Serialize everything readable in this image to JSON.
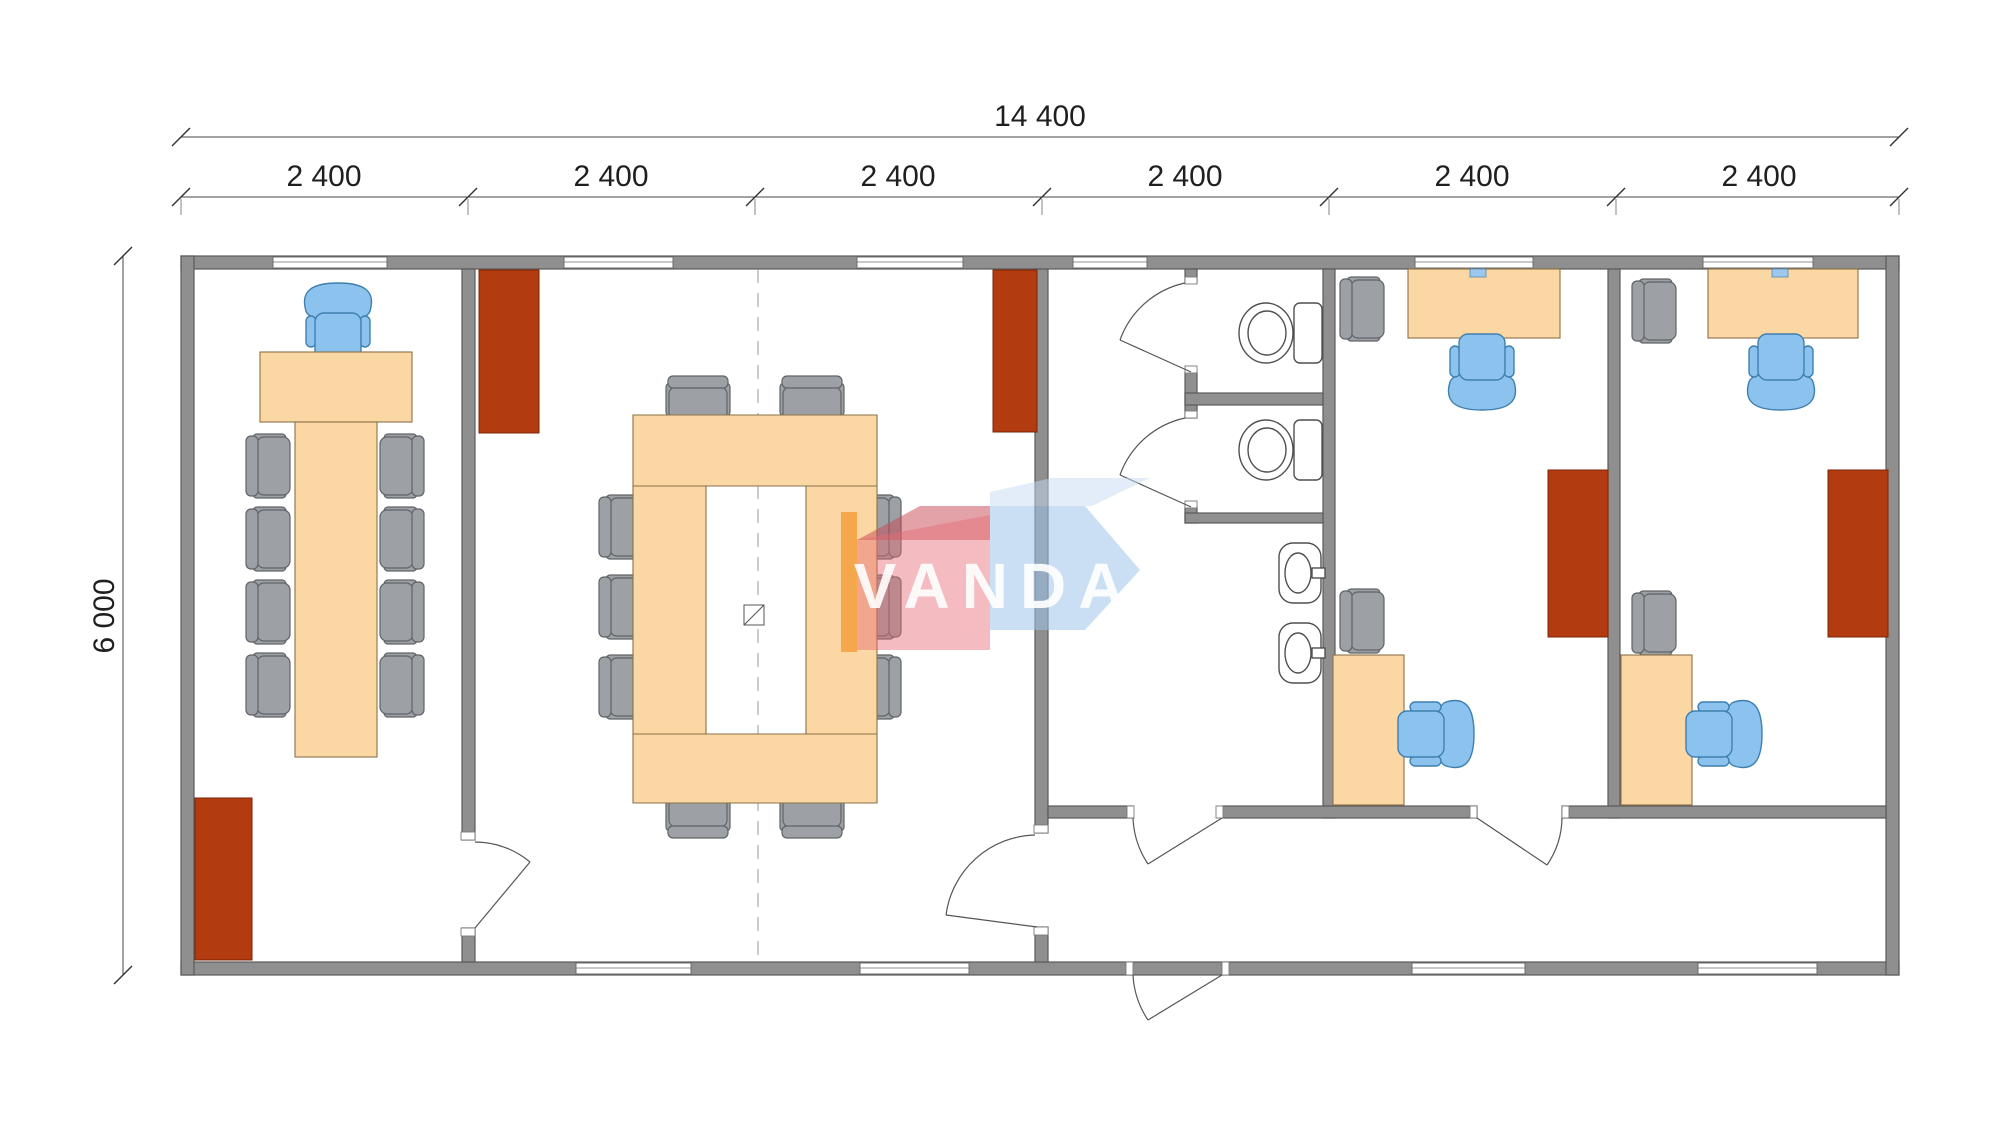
{
  "dims": {
    "total": "14 400",
    "height": "6 000",
    "segments": [
      "2 400",
      "2 400",
      "2 400",
      "2 400",
      "2 400",
      "2 400"
    ]
  },
  "watermark": {
    "text": "VANDA"
  },
  "colors": {
    "wall": "#8f8f8f",
    "wallStroke": "#5a5a5a",
    "window": "#ffffff",
    "furniture": "#fbd7a3",
    "furnitureStroke": "#8a7148",
    "chairBlue": "#8cc3ee",
    "chairBlueStroke": "#3f7fae",
    "chairGray": "#9da1a6",
    "chairGrayStroke": "#606468",
    "cabinet": "#b23c10",
    "cabinetStroke": "#7c2504",
    "doorStroke": "#555555",
    "fixture": "#ffffff",
    "fixtureStroke": "#4f4f4f",
    "monitor": "#9cc8f0",
    "dimColor": "#1f1f1f",
    "dashColor": "#9a9a9a",
    "wmPink": "rgba(231,106,115,0.45)",
    "wmPinkDark": "rgba(200,70,82,0.5)",
    "wmBlue": "rgba(158,196,234,0.55)",
    "wmBlueLight": "rgba(198,220,243,0.5)",
    "wmOrange": "rgba(242,160,60,0.85)",
    "wmText": "rgba(255,255,255,0.9)"
  }
}
